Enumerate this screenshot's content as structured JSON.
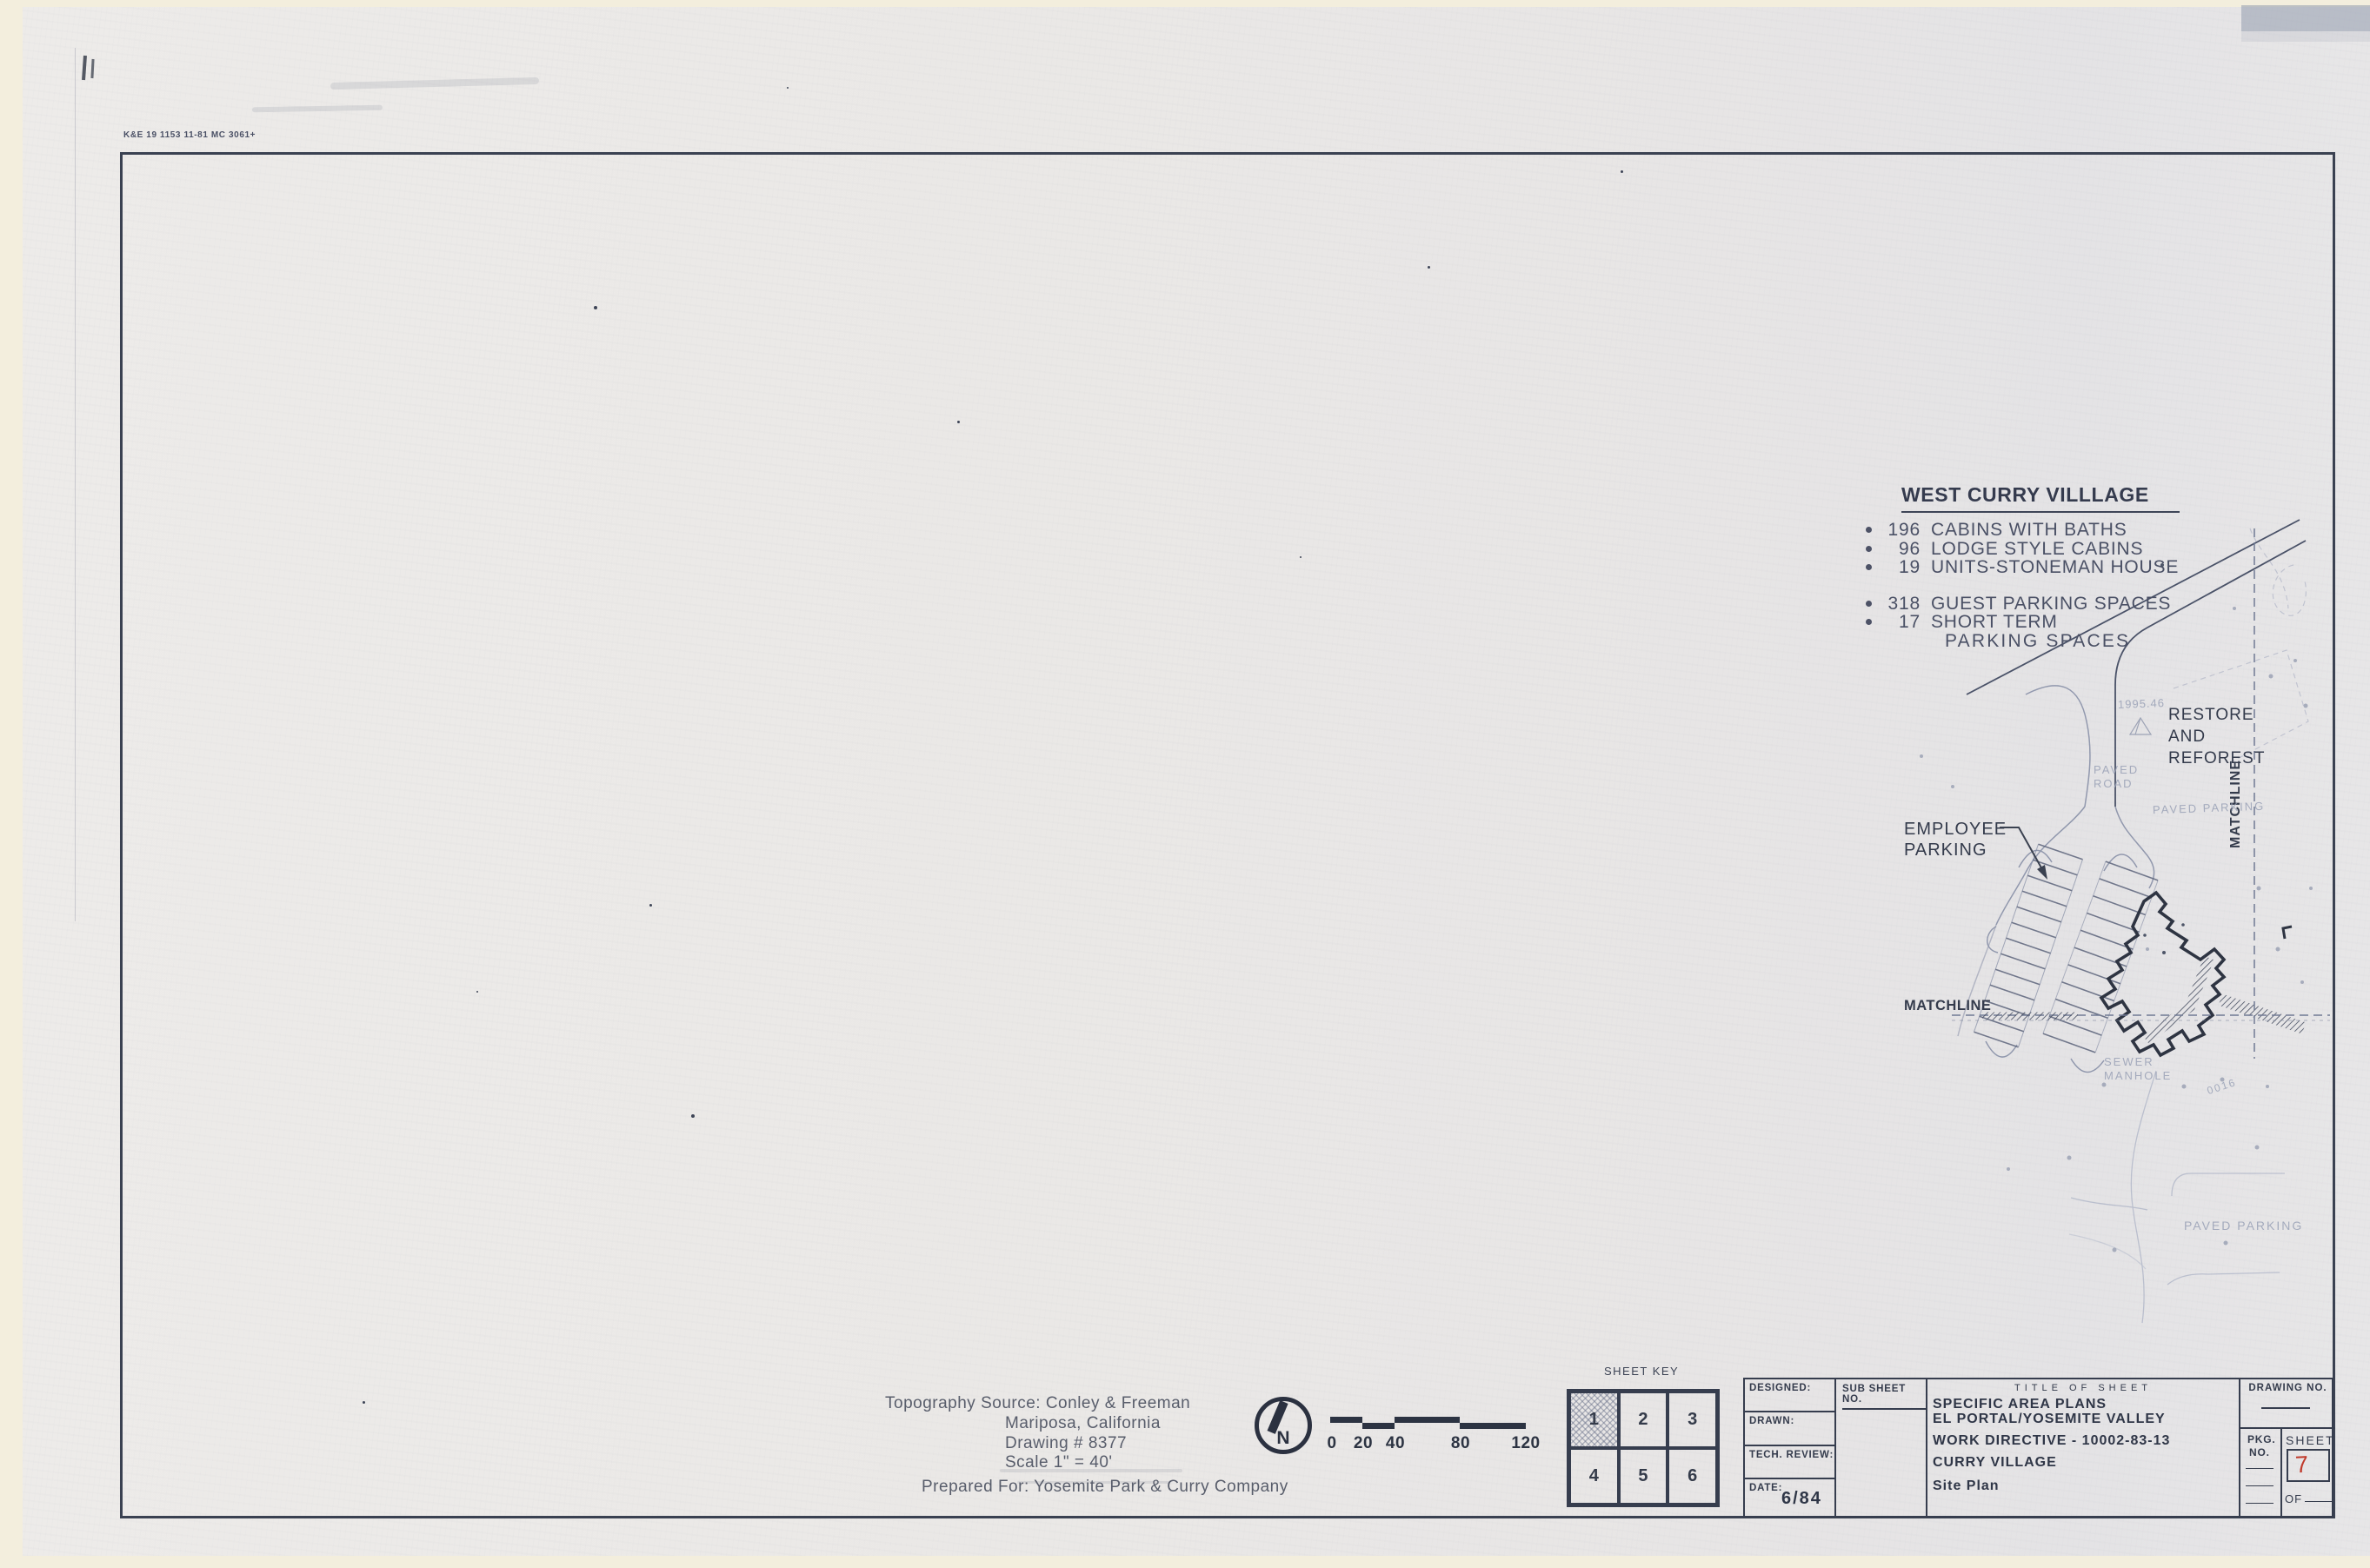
{
  "stamp": "K&E 19 1153 11-81 MC 3061+",
  "colors": {
    "ink": "#39404f",
    "paper": "#e9e7e5",
    "sheet_number_red": "#c03a2b",
    "faint_plan": "#99a1b6"
  },
  "notes": {
    "title": "WEST CURRY VILLLAGE",
    "items": [
      {
        "num": "196",
        "text": "CABINS WITH BATHS"
      },
      {
        "num": "96",
        "text": "LODGE STYLE CABINS"
      },
      {
        "num": "19",
        "text": "UNITS-STONEMAN HOUSE"
      },
      {
        "num": "318",
        "text": "GUEST PARKING SPACES"
      },
      {
        "num": "17",
        "text": "SHORT TERM"
      }
    ],
    "continuation": "PARKING SPACES"
  },
  "plan": {
    "restore": [
      "RESTORE",
      "AND",
      "REFOREST"
    ],
    "employee": [
      "EMPLOYEE",
      "PARKING"
    ],
    "matchline": "MATCHLINE",
    "elevation": "1995.46",
    "paved_road": [
      "PAVED",
      "ROAD"
    ],
    "paved_parking": "PAVED PARKING",
    "sewer": [
      "SEWER",
      "MANHOLE"
    ],
    "contour": "0016"
  },
  "credits": {
    "line1": "Topography Source: Conley & Freeman",
    "line2": "Mariposa, California",
    "line3": "Drawing # 8377",
    "line4": "Scale 1\" = 40'",
    "line5": "Prepared For: Yosemite Park & Curry Company"
  },
  "north": {
    "label": "N"
  },
  "scalebar": {
    "labels": [
      "0",
      "20",
      "40",
      "80",
      "120"
    ]
  },
  "sheet_key": {
    "title": "SHEET KEY",
    "cells": [
      "1",
      "2",
      "3",
      "4",
      "5",
      "6"
    ]
  },
  "tb": {
    "designed": "DESIGNED:",
    "drawn": "DRAWN:",
    "tech": "TECH. REVIEW:",
    "date_label": "DATE:",
    "date_value": "6/84",
    "sub": "SUB SHEET NO.",
    "title_header": "TITLE OF SHEET",
    "l1": "SPECIFIC AREA PLANS",
    "l2": "EL PORTAL/YOSEMITE VALLEY",
    "l3": "WORK DIRECTIVE - 10002-83-13",
    "l4": "CURRY VILLAGE",
    "l5": "Site Plan",
    "drawing_no": "DRAWING NO.",
    "pkg": [
      "PKG.",
      "NO."
    ],
    "sheet": "SHEET",
    "sheet_value": "7",
    "of": "OF"
  }
}
